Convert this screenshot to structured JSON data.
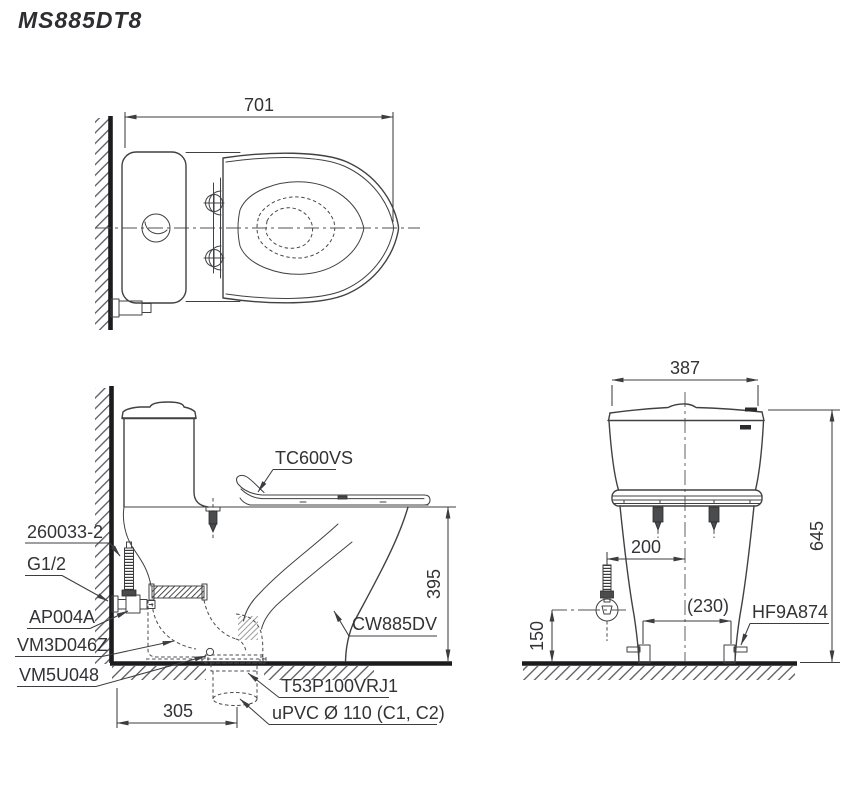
{
  "title": "MS885DT8",
  "colors": {
    "line": "#404143",
    "text": "#333336",
    "wall": "#1c1c1e",
    "bg": "#ffffff"
  },
  "top_view": {
    "dims": {
      "total_depth": "701"
    }
  },
  "side_view": {
    "parts": {
      "seat": "TC600VS",
      "supply_hose": "260033-2",
      "thread": "G1/2",
      "stop_valve": "AP004A",
      "inlet_valve": "VM3D046Z",
      "flush_valve": "VM5U048",
      "bowl": "CW885DV",
      "outlet_flange": "T53P100VRJ1",
      "drain_pipe": "uPVC Ø 110 (C1, C2)"
    },
    "dims": {
      "rim_height": "395",
      "outlet_offset": "305"
    }
  },
  "rear_view": {
    "parts": {
      "bolt_cap": "HF9A874"
    },
    "dims": {
      "tank_width": "387",
      "total_height": "645",
      "supply_offset": "200",
      "bolt_spacing": "(230)",
      "supply_height": "150"
    }
  }
}
